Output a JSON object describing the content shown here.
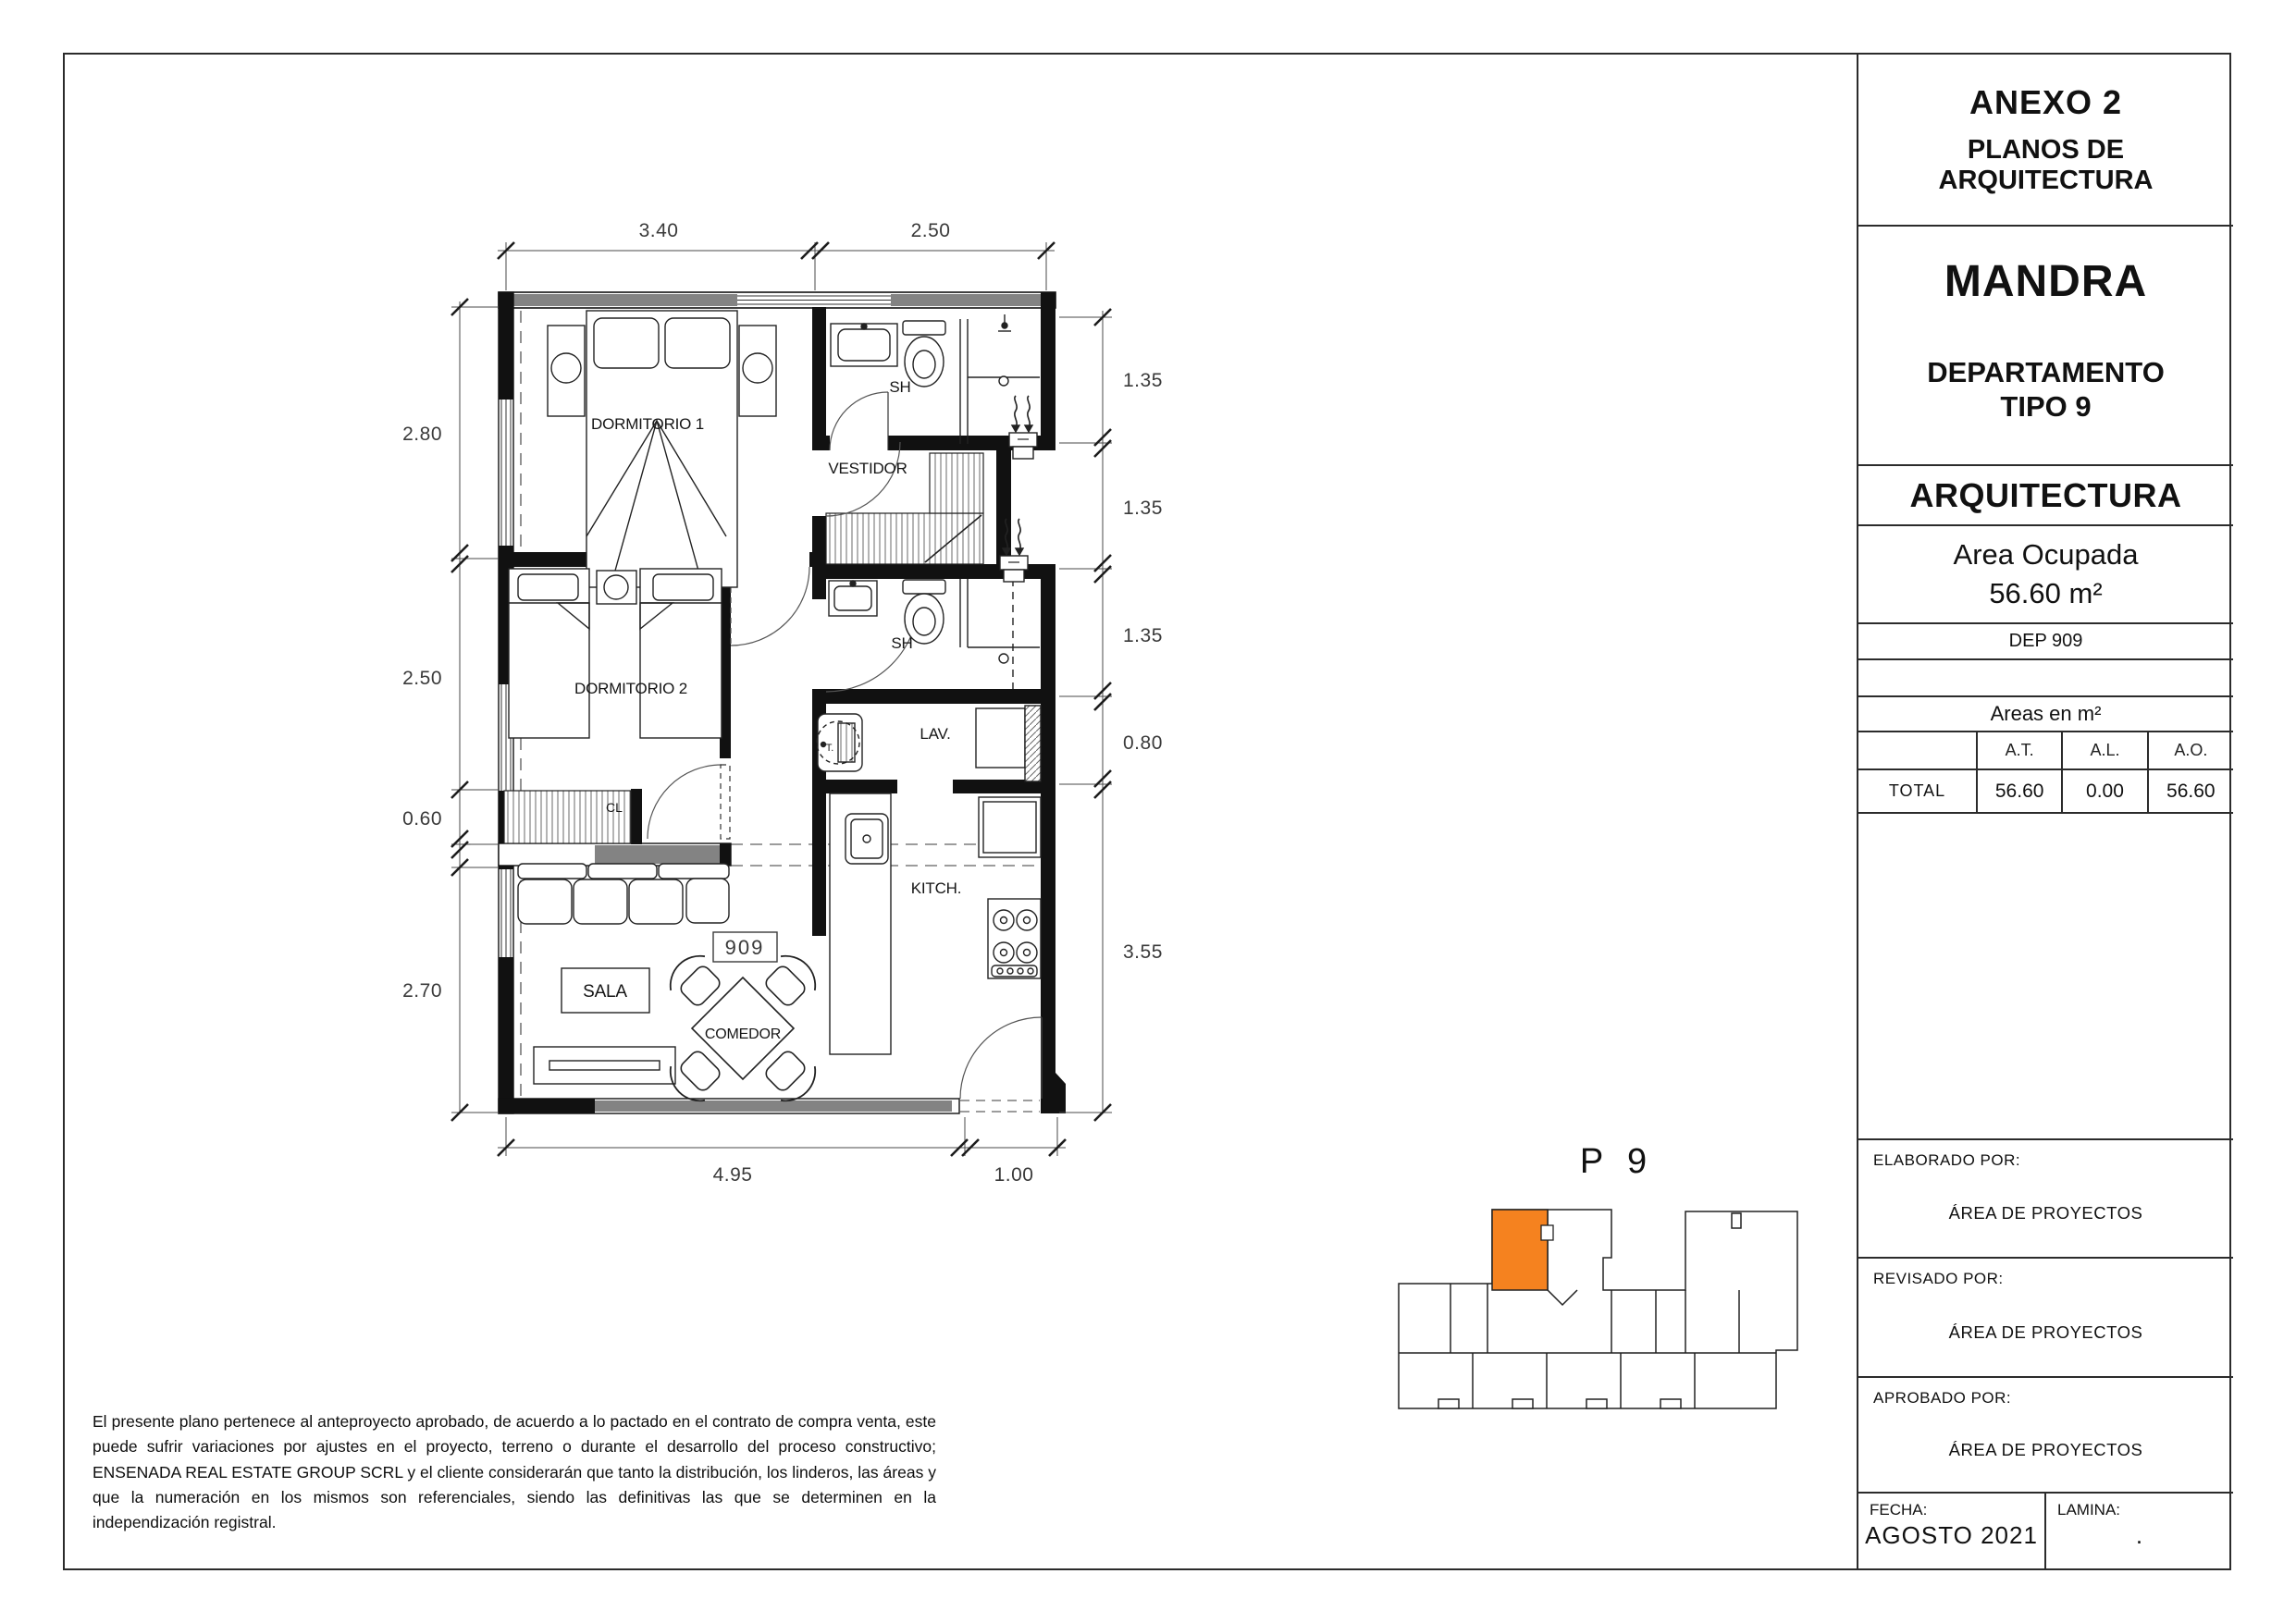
{
  "title_block": {
    "annex_title": "ANEXO 2",
    "annex_subtitle": "PLANOS DE ARQUITECTURA",
    "project_name": "MANDRA",
    "unit_type_line1": "DEPARTAMENTO",
    "unit_type_line2": "TIPO 9",
    "discipline": "ARQUITECTURA",
    "area_label": "Area Ocupada",
    "area_value": "56.60 m²",
    "unit_code": "DEP 909",
    "areas_table": {
      "caption": "Areas en m²",
      "columns": [
        "A.T.",
        "A.L.",
        "A.O."
      ],
      "row_label": "TOTAL",
      "values": [
        "56.60",
        "0.00",
        "56.60"
      ]
    },
    "elaborated_label": "ELABORADO POR:",
    "elaborated_value": "ÁREA DE PROYECTOS",
    "revised_label": "REVISADO POR:",
    "revised_value": "ÁREA DE PROYECTOS",
    "approved_label": "APROBADO POR:",
    "approved_value": "ÁREA DE PROYECTOS",
    "date_label": "FECHA:",
    "date_value": "AGOSTO 2021",
    "sheet_label": "LAMINA:",
    "sheet_value": "."
  },
  "plan": {
    "unit_number": "909",
    "washer_label": "T.",
    "rooms": {
      "dormitorio1": "DORMITORIO 1",
      "dormitorio2": "DORMITORIO 2",
      "vestidor": "VESTIDOR",
      "sh_upper": "SH",
      "sh_lower": "SH",
      "lavanderia": "LAV.",
      "closet": "CL",
      "kitchen": "KITCH.",
      "sala": "SALA",
      "comedor": "COMEDOR"
    },
    "dims": {
      "top": [
        "3.40",
        "2.50"
      ],
      "left": [
        "2.80",
        "2.50",
        "0.60",
        "2.70"
      ],
      "right": [
        "1.35",
        "1.35",
        "1.35",
        "0.80",
        "3.55"
      ],
      "bottom": [
        "4.95",
        "1.00"
      ]
    }
  },
  "key_plan": {
    "label": "P 9"
  },
  "disclaimer": {
    "text": "El presente plano pertenece al anteproyecto aprobado, de acuerdo a lo pactado en el contrato de compra venta, este puede sufrir variaciones por ajustes en el proyecto, terreno o durante el desarrollo del proceso constructivo; ENSENADA REAL ESTATE GROUP SCRL y el cliente considerarán que tanto la distribución, los linderos, las áreas y que la numeración en los mismos son referenciales, siendo las definitivas las que se determinen en la independización registral."
  },
  "colors": {
    "accent_orange": "#F5821F",
    "wall_gray": "#838383"
  }
}
